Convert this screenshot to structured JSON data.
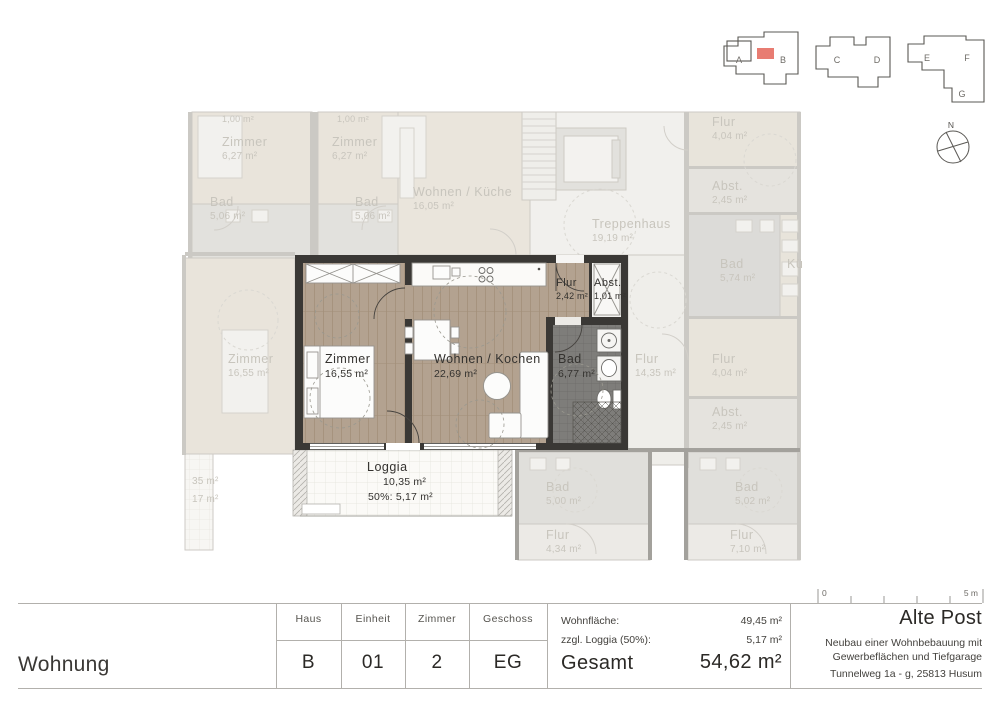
{
  "building_key": {
    "a": "A",
    "b": "B",
    "c": "C",
    "d": "D",
    "e": "E",
    "f": "F",
    "g": "G",
    "north": "N",
    "highlight_color": "#e87c72"
  },
  "plan": {
    "rooms": {
      "zimmer": {
        "name": "Zimmer",
        "area": "16,55 m²"
      },
      "wohnen": {
        "name": "Wohnen / Kochen",
        "area": "22,69 m²"
      },
      "flur": {
        "name": "Flur",
        "area": "2,42 m²"
      },
      "abst": {
        "name": "Abst.",
        "area": "1,01 m²"
      },
      "bad": {
        "name": "Bad",
        "area": "6,77 m²"
      },
      "loggia": {
        "name": "Loggia",
        "area": "10,35 m²",
        "area_50": "50%: 5,17 m²"
      }
    },
    "context": [
      {
        "name": "",
        "area": "1,00 m²"
      },
      {
        "name": "Zimmer",
        "area": "6,27 m²"
      },
      {
        "name": "",
        "area": "1,00 m²"
      },
      {
        "name": "Zimmer",
        "area": "6,27 m²"
      },
      {
        "name": "Bad",
        "area": "5,06 m²"
      },
      {
        "name": "Bad",
        "area": "5,06 m²"
      },
      {
        "name": "Wohnen / Küche",
        "area": "16,05 m²"
      },
      {
        "name": "Treppenhaus",
        "area": "19,19 m²"
      },
      {
        "name": "Flur",
        "area": "4,04 m²"
      },
      {
        "name": "Abst.",
        "area": "2,45 m²"
      },
      {
        "name": "Bad",
        "area": "5,74 m²"
      },
      {
        "name": "Kü",
        "area": ""
      },
      {
        "name": "Flur",
        "area": "14,35 m²"
      },
      {
        "name": "Flur",
        "area": "4,04 m²"
      },
      {
        "name": "Abst.",
        "area": "2,45 m²"
      },
      {
        "name": "Zimmer",
        "area": "16,55 m²"
      },
      {
        "name": "",
        "area": "35 m²"
      },
      {
        "name": "",
        "area": "17 m²"
      },
      {
        "name": "Bad",
        "area": "5,00 m²"
      },
      {
        "name": "Flur",
        "area": "4,34 m²"
      },
      {
        "name": "Bad",
        "area": "5,02 m²"
      },
      {
        "name": "Flur",
        "area": "7,10 m²"
      }
    ]
  },
  "title_block": {
    "sheet_title": "Wohnung",
    "columns": [
      {
        "label": "Haus",
        "value": "B"
      },
      {
        "label": "Einheit",
        "value": "01"
      },
      {
        "label": "Zimmer",
        "value": "2"
      },
      {
        "label": "Geschoss",
        "value": "EG"
      }
    ],
    "areas": {
      "living_label": "Wohnfläche:",
      "living_value": "49,45 m²",
      "loggia_label": "zzgl. Loggia (50%):",
      "loggia_value": "5,17 m²",
      "total_label": "Gesamt",
      "total_value": "54,62 m²"
    },
    "project": {
      "name": "Alte Post",
      "desc1": "Neubau einer Wohnbebauung mit",
      "desc2": "Gewerbeflächen und Tiefgarage",
      "address": "Tunnelweg 1a - g, 25813 Husum"
    }
  },
  "scale_bar": {
    "zero": "0",
    "five": "5 m"
  }
}
